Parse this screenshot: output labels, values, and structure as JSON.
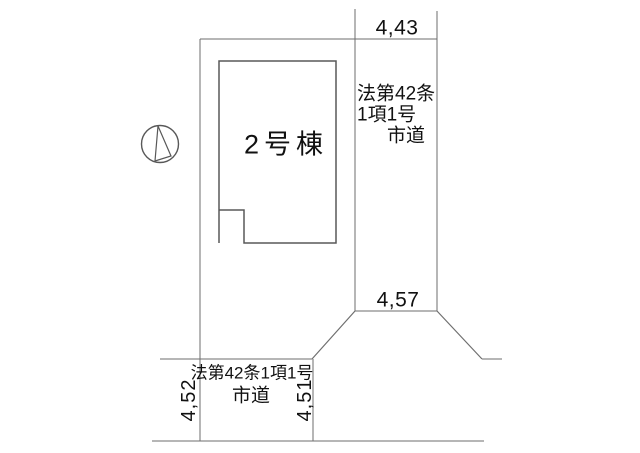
{
  "page": {
    "background": "#ffffff"
  },
  "diagram": {
    "building": {
      "label": "2号棟"
    },
    "north_symbol": "north-arrow-icon",
    "right_road": {
      "dim_top": "4,43",
      "dim_bottom": "4,57",
      "label_line1": "法第42条",
      "label_line2": "1項1号",
      "label_line3": "市道"
    },
    "bottom_road": {
      "label_line1": "法第42条1項1号",
      "label_line2": "市道",
      "dim_left": "4,52",
      "dim_right": "4,51"
    },
    "colors": {
      "line": "#6e6e6e",
      "building_line": "#585858",
      "text": "#111111"
    }
  }
}
